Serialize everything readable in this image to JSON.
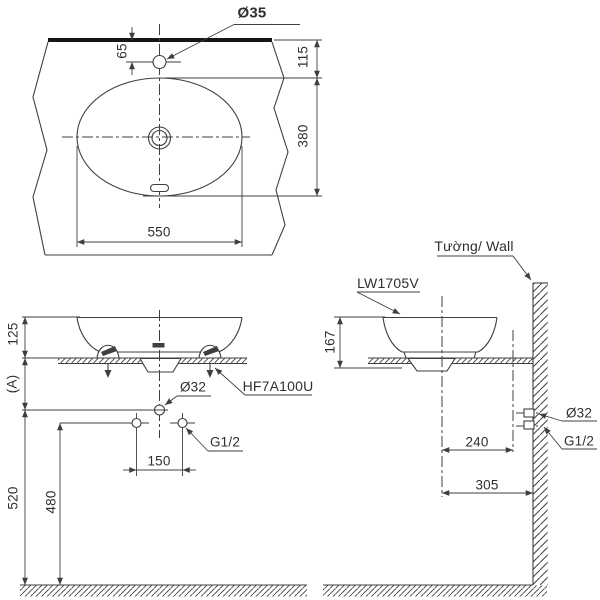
{
  "colors": {
    "background": "#ffffff",
    "line": "#3f3f3f",
    "thick_line": "#161616",
    "text": "#2f2f2f"
  },
  "top_view": {
    "faucet_hole_dia": "Ø35",
    "hole_to_edge": "65",
    "edge_to_basin": "115",
    "basin_depth": "380",
    "basin_width": "550"
  },
  "front_view": {
    "rim_to_counter": "125",
    "counter_to_drain": "(A)",
    "drain_to_floor": "520",
    "supply_to_floor": "480",
    "drain_dia": "Ø32",
    "bracket_model": "HF7A100U",
    "supply_thread": "G1/2",
    "supply_spacing": "150"
  },
  "side_view": {
    "wall_label": "Tường/ Wall",
    "product_code": "LW1705V",
    "basin_height": "167",
    "center_to_supply": "240",
    "center_to_wall": "305",
    "drain_dia": "Ø32",
    "supply_thread": "G1/2"
  }
}
